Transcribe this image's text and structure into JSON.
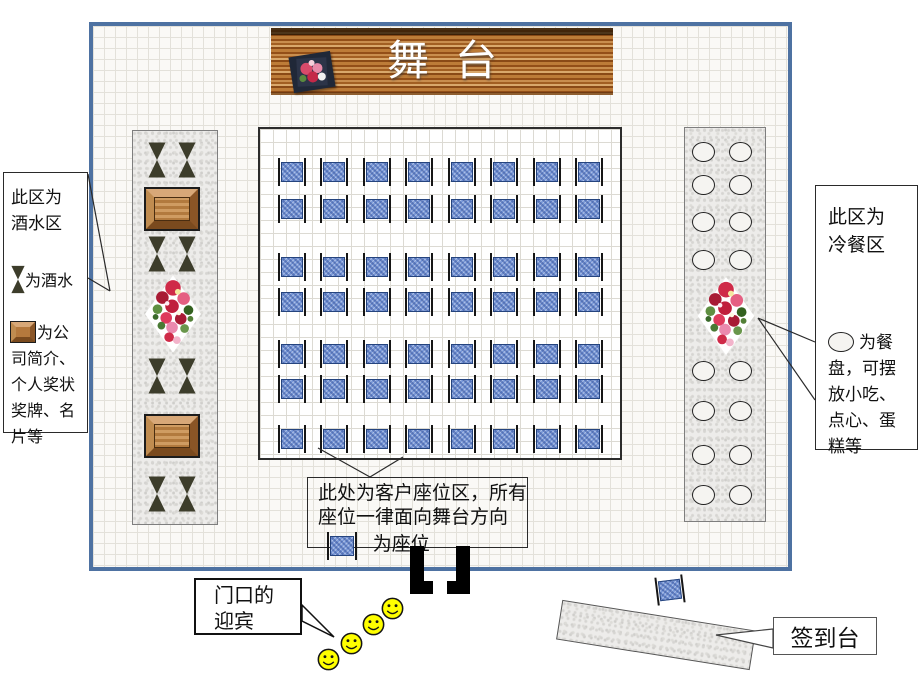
{
  "stage": {
    "label": "舞台"
  },
  "drink_area": {
    "callout": {
      "title_lines": [
        "此区为",
        "酒水区"
      ],
      "legend": [
        {
          "icon": "hourglass-icon",
          "label": "为酒水"
        },
        {
          "icon": "wooden-box-icon",
          "label": "为公司简介、个人奖状奖牌、名片等"
        }
      ]
    },
    "items": [
      "hourglass-pair",
      "wooden-box",
      "hourglass-pair",
      "flower-bouquet",
      "hourglass-pair",
      "wooden-box",
      "hourglass-pair"
    ]
  },
  "buffet_area": {
    "callout": {
      "title_lines": [
        "此区为",
        "冷餐区"
      ],
      "legend": [
        {
          "icon": "plate-icon",
          "label": "为餐盘，可摆放小吃、点心、蛋糕等"
        }
      ]
    },
    "plate_rows": 8,
    "plates_per_row": 2
  },
  "seating_area": {
    "rows": 7,
    "cols": 8,
    "callout": {
      "lines": [
        "此处为客户座位区，所有",
        "座位一律面向舞台方向"
      ],
      "legend_icon": "seat-icon",
      "legend_label": "为座位"
    }
  },
  "entrance": {
    "bubble_lines": [
      "门口的",
      "迎宾"
    ],
    "greeter_count": 4
  },
  "signin": {
    "label": "签到台"
  },
  "colors": {
    "room_border": "#4e72a2",
    "seat_blue": "#7a99d8",
    "wood_brown": "#a25f22",
    "hourglass_olive": "#3d3d2b",
    "smiley_yellow": "#ffff00",
    "granite": "#edecea"
  }
}
